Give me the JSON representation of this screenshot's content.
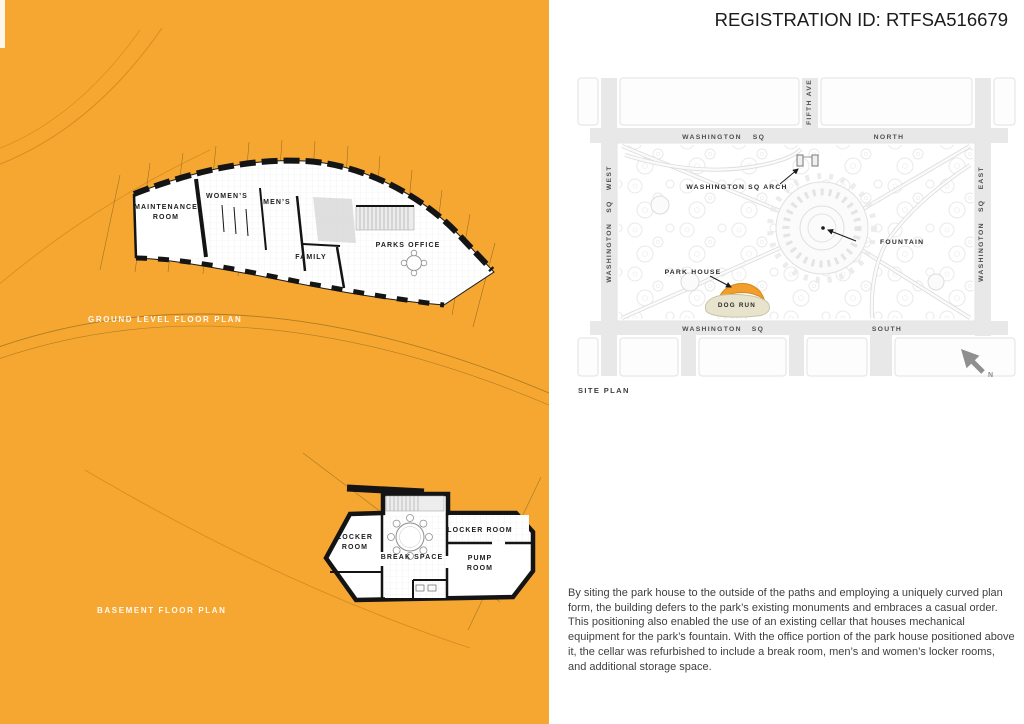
{
  "header": {
    "registration_id": "REGISTRATION ID: RTFSA516679"
  },
  "ground_plan": {
    "caption": "GROUND LEVEL FLOOR PLAN",
    "rooms": {
      "maintenance_line1": "MAINTENANCE",
      "maintenance_line2": "ROOM",
      "womens": "WOMEN’S",
      "mens": "MEN’S",
      "family": "FAMILY",
      "parks_office": "PARKS OFFICE"
    }
  },
  "basement_plan": {
    "caption": "BASEMENT FLOOR PLAN",
    "rooms": {
      "locker_left_line1": "LOCKER",
      "locker_left_line2": "ROOM",
      "break_space": "BREAK SPACE",
      "locker_right": "LOCKER ROOM",
      "pump_line1": "PUMP",
      "pump_line2": "ROOM"
    }
  },
  "site_plan": {
    "caption": "SITE PLAN",
    "streets": {
      "washington": "WASHINGTON",
      "sq": "SQ",
      "north": "NORTH",
      "south": "SOUTH",
      "west_full": "WASHINGTON SQ WEST",
      "east_full": "WASHINGTON SQ EAST",
      "fifth_ave": "FIFTH AVE"
    },
    "features": {
      "arch": "WASHINGTON SQ ARCH",
      "fountain": "FOUNTAIN",
      "park_house": "PARK HOUSE",
      "dog_run": "DOG RUN"
    },
    "north_indicator": "N"
  },
  "description": "By siting the park house to the outside of the paths and employing a uniquely curved plan form, the building defers to the park’s existing monuments and embraces a casual order. This positioning also enabled the use of an existing cellar that houses mechanical equipment for the park’s fountain. With the office portion of the park house positioned above it, the cellar was refurbished to include a break room, men’s and women’s locker rooms, and additional storage space.",
  "colors": {
    "panel_orange": "#F5A732",
    "park_house_orange": "#F19E2C",
    "dog_run_beige": "#E7E3CC",
    "street_gray": "#E8E8E8",
    "north_arrow_gray": "#8F8F8F"
  }
}
